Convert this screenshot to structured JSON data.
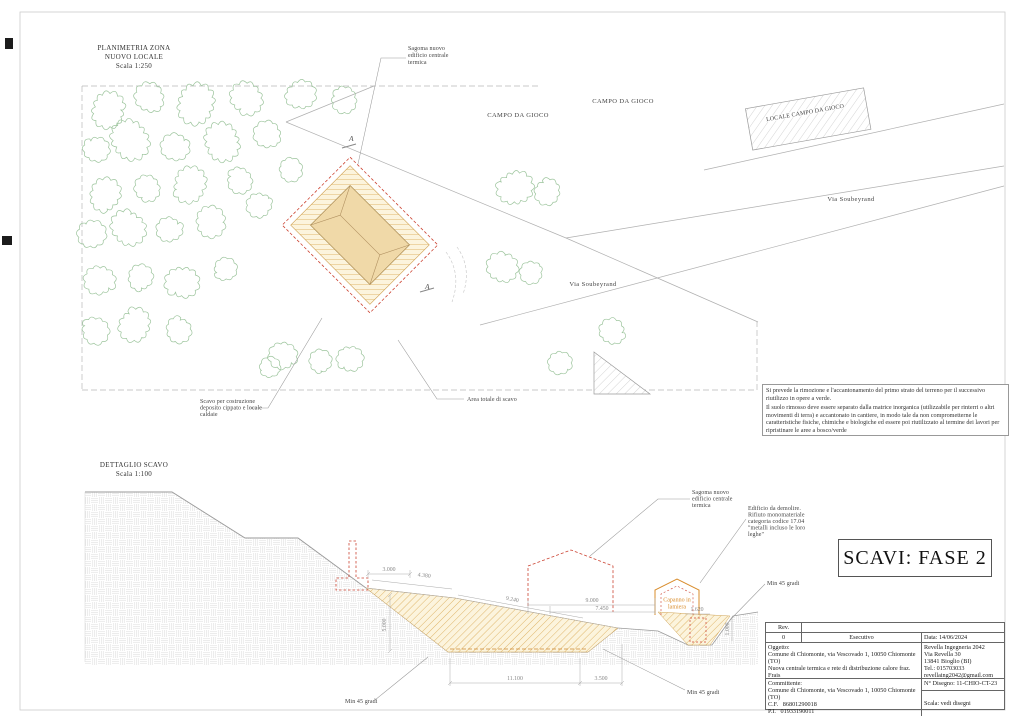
{
  "sheet": {
    "plan_title": [
      "PLANIMETRIA ZONA",
      "NUOVO LOCALE",
      "Scala 1:250"
    ],
    "detail_title": [
      "DETTAGLIO SCAVO",
      "Scala 1:100"
    ],
    "stamp": "SCAVI: FASE 2"
  },
  "plan": {
    "campo1": "CAMPO DA GIOCO",
    "campo2": "CAMPO DA GIOCO",
    "locale_campo": "LOCALE CAMPO DA GIOCO",
    "via1": "Via Soubeyrand",
    "via2": "Via Soubeyrand",
    "sagoma": [
      "Sagoma nuovo",
      "edificio centrale",
      "termica"
    ],
    "scavo": [
      "Scavo per costruzione",
      "deposito cippato e locale",
      "caldaie"
    ],
    "area": "Area totale di scavo",
    "section_a": "A",
    "note": [
      "Si prevede la rimozione e l'accantonamento del primo strato del terreno per il successivo riutilizzo in opere a verde.",
      "Il suolo rimosso deve essere separato dalla matrice inorganica (utilizzabile per rinterri o altri movimenti di terra) e accantonato in cantiere, in modo tale da non comprometterne le caratteristiche fisiche, chimiche e biologiche ed essere poi riutilizzato al termine dei lavori per ripristinare le aree a bosco/verde"
    ]
  },
  "section": {
    "sagoma": [
      "Sagoma nuovo",
      "edificio centrale",
      "termica"
    ],
    "demolire": [
      "Edificio da demolire.",
      "Rifiuto monomateriale",
      "categoria codice 17.04",
      "\"metalli incluso le loro",
      "leghe\""
    ],
    "capanno": [
      "Capanno in",
      "lamiera"
    ],
    "min45_a": "Min 45 gradi",
    "min45_b": "Min 45 gradi",
    "min45_c": "Min 45 gradi",
    "dims": {
      "a": "3.000",
      "b": "4.380",
      "c": "9.240",
      "d": "5.000",
      "e": "9.000",
      "f": "7.450",
      "g": "1.620",
      "h": "1.000",
      "i": "11.100",
      "j": "3.500"
    }
  },
  "titleblock": {
    "rev_label": "Rev.",
    "rev_number": "0",
    "rev_name": "Esecutivo",
    "date": "Data: 14/06/2024",
    "oggetto_label": "Oggetto:",
    "oggetto_line1": "Comune di Chiomonte, via Vescovado 1, 10050 Chiomonte (TO)",
    "oggetto_line2": "Nuova centrale termica e rete di distribuzione calore fraz. Frais",
    "oggetto_line3": "Scavi - fase 2",
    "firm_line1": "Revella Ingegneria 2042",
    "firm_line2": "Via Revella 30",
    "firm_line3": "13841 Bioglio (BI)",
    "firm_line4": "Tel.: 015703033",
    "firm_line5": "revellaing2042@gmail.com",
    "committente_label": "Committente:",
    "committente_line1": "Comune di Chiomonte, via Vescovado 1, 10050 Chiomonte (TO)",
    "committente_cf": "C.F.   86801290018",
    "committente_pi": "P.I.   01933190011",
    "drawing_no": "N° Disegno: 11-CHIO-CT-23",
    "scale": "Scala: vedi disegni"
  },
  "colors": {
    "tree_green": "#9cc49c",
    "excavation_hatch": "#dcaf5e",
    "red_dashed": "#cc4433",
    "shed_orange": "#d98c2b"
  }
}
